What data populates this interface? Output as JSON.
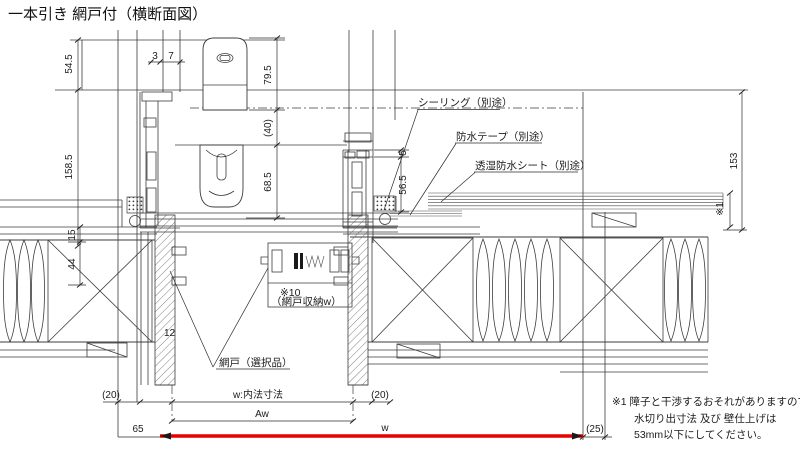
{
  "title": "一本引き 網戸付（横断面図）",
  "colors": {
    "line": "#3c3c3c",
    "accent_red": "#e60000"
  },
  "callouts": {
    "sealing": "シーリング（別途）",
    "tape": "防水テープ（別途）",
    "sheet": "透湿防水シート（別途）",
    "screen": "網戸（選択品）",
    "pocket_ref": "※10",
    "pocket_label": "（網戸収納w）"
  },
  "dimensions": {
    "d54_5": "54.5",
    "d158_5": "158.5",
    "d3": "3",
    "d7": "7",
    "d79_5": "79.5",
    "d40": "(40)",
    "d68_5": "68.5",
    "d5": "5",
    "d56_5": "56.5",
    "d153": "153",
    "ref1": "※1",
    "d15": "15",
    "d44": "44",
    "d12": "12",
    "d20_left": "(20)",
    "w_inner": "w:内法寸法",
    "d20_right": "(20)",
    "aw": "Aw",
    "d65": "65",
    "w": "w",
    "d25": "(25)"
  },
  "note": {
    "line1": "※1 障子と干渉するおそれがありますので",
    "line2": "水切り出寸法 及び 壁仕上げは",
    "line3": "53mm以下にしてください。"
  }
}
